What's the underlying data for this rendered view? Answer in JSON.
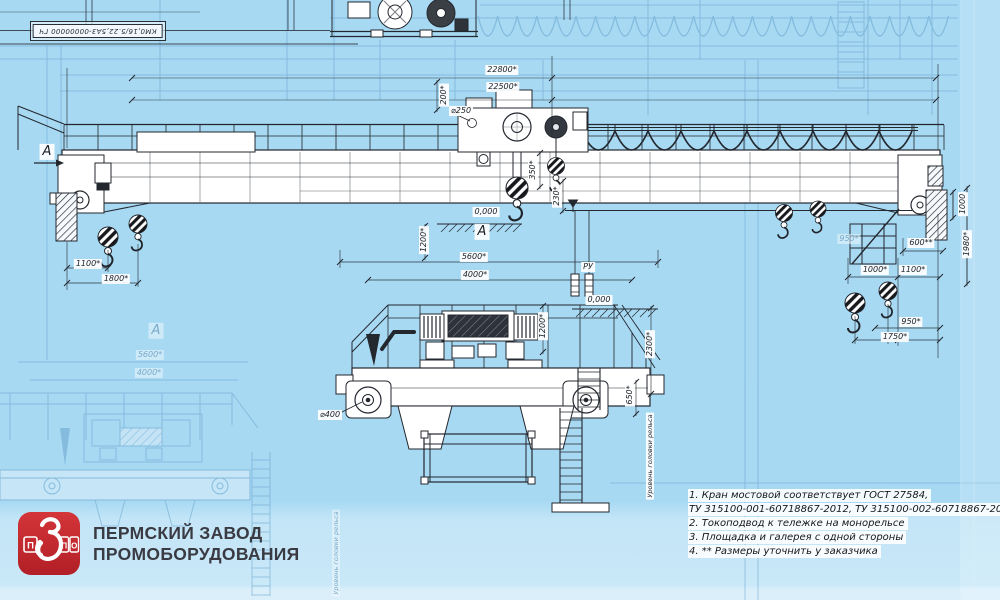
{
  "drawing_stamp": {
    "code": "КМ0,16/5.22,5А3-00000000 ГЧ"
  },
  "labels": [
    {
      "t": "22800*",
      "x": 502,
      "y": 70,
      "cls": ""
    },
    {
      "t": "22500*",
      "x": 503,
      "y": 87,
      "cls": ""
    },
    {
      "t": "⌀250",
      "x": 461,
      "y": 111,
      "cls": ""
    },
    {
      "t": "200*",
      "x": 444,
      "y": 95,
      "cls": "r90"
    },
    {
      "t": "350*",
      "x": 533,
      "y": 170,
      "cls": "r90"
    },
    {
      "t": "230*",
      "x": 557,
      "y": 196,
      "cls": "r90"
    },
    {
      "t": "0,000",
      "x": 486,
      "y": 212,
      "cls": ""
    },
    {
      "t": "А",
      "x": 482,
      "y": 232,
      "cls": "big"
    },
    {
      "t": "5600*",
      "x": 474,
      "y": 257,
      "cls": ""
    },
    {
      "t": "4000*",
      "x": 475,
      "y": 275,
      "cls": ""
    },
    {
      "t": "РУ",
      "x": 588,
      "y": 267,
      "cls": ""
    },
    {
      "t": "1100*",
      "x": 88,
      "y": 264,
      "cls": ""
    },
    {
      "t": "1800*",
      "x": 116,
      "y": 279,
      "cls": ""
    },
    {
      "t": "1000",
      "x": 963,
      "y": 204,
      "cls": "r90"
    },
    {
      "t": "1980*",
      "x": 967,
      "y": 244,
      "cls": "r90"
    },
    {
      "t": "600**",
      "x": 921,
      "y": 243,
      "cls": ""
    },
    {
      "t": "1000*",
      "x": 875,
      "y": 270,
      "cls": ""
    },
    {
      "t": "1100*",
      "x": 913,
      "y": 270,
      "cls": ""
    },
    {
      "t": "950*",
      "x": 911,
      "y": 322,
      "cls": ""
    },
    {
      "t": "1750*",
      "x": 895,
      "y": 337,
      "cls": ""
    },
    {
      "t": "1200*",
      "x": 424,
      "y": 240,
      "cls": "r90"
    },
    {
      "t": "1200*",
      "x": 543,
      "y": 326,
      "cls": "r90"
    },
    {
      "t": "2300*",
      "x": 650,
      "y": 344,
      "cls": "r90"
    },
    {
      "t": "650*",
      "x": 630,
      "y": 395,
      "cls": "r90"
    },
    {
      "t": "⌀400",
      "x": 330,
      "y": 415,
      "cls": ""
    },
    {
      "t": "0,000",
      "x": 599,
      "y": 300,
      "cls": ""
    },
    {
      "t": "Уровень головки рельса",
      "x": 650,
      "y": 456,
      "cls": "r90 tiny"
    },
    {
      "t": "А",
      "x": 47,
      "y": 152,
      "cls": "big"
    },
    {
      "t": "А",
      "x": 156,
      "y": 331,
      "cls": "big faint"
    },
    {
      "t": "5600*",
      "x": 150,
      "y": 355,
      "cls": "faint"
    },
    {
      "t": "4000*",
      "x": 149,
      "y": 373,
      "cls": "faint"
    },
    {
      "t": "950*",
      "x": 849,
      "y": 239,
      "cls": "faint"
    },
    {
      "t": "Уровень головки рельса",
      "x": 336,
      "y": 553,
      "cls": "r90 tiny faint"
    }
  ],
  "notes": {
    "lines": [
      "1. Кран мостовой соответствует ГОСТ 27584,",
      "ТУ 315100-001-60718867-2012, ТУ 315100-002-60718867-2014.",
      "2. Токоподвод к тележке на монорельсе",
      "3. Площадка и галерея с одной стороны",
      "4.  ** Размеры уточнить у заказчика"
    ]
  },
  "logo": {
    "icon_letters": [
      "П",
      "П",
      "О"
    ],
    "name_line1": "ПЕРМСКИЙ ЗАВОД",
    "name_line2": "ПРОМОБОРУДОВАНИЯ"
  },
  "colors": {
    "background": "#a7d9f3",
    "line": "#23272e",
    "watermark": "#6aa6cd",
    "logo_red": "#c5262c",
    "bottom_band": "#c9e8f8"
  }
}
